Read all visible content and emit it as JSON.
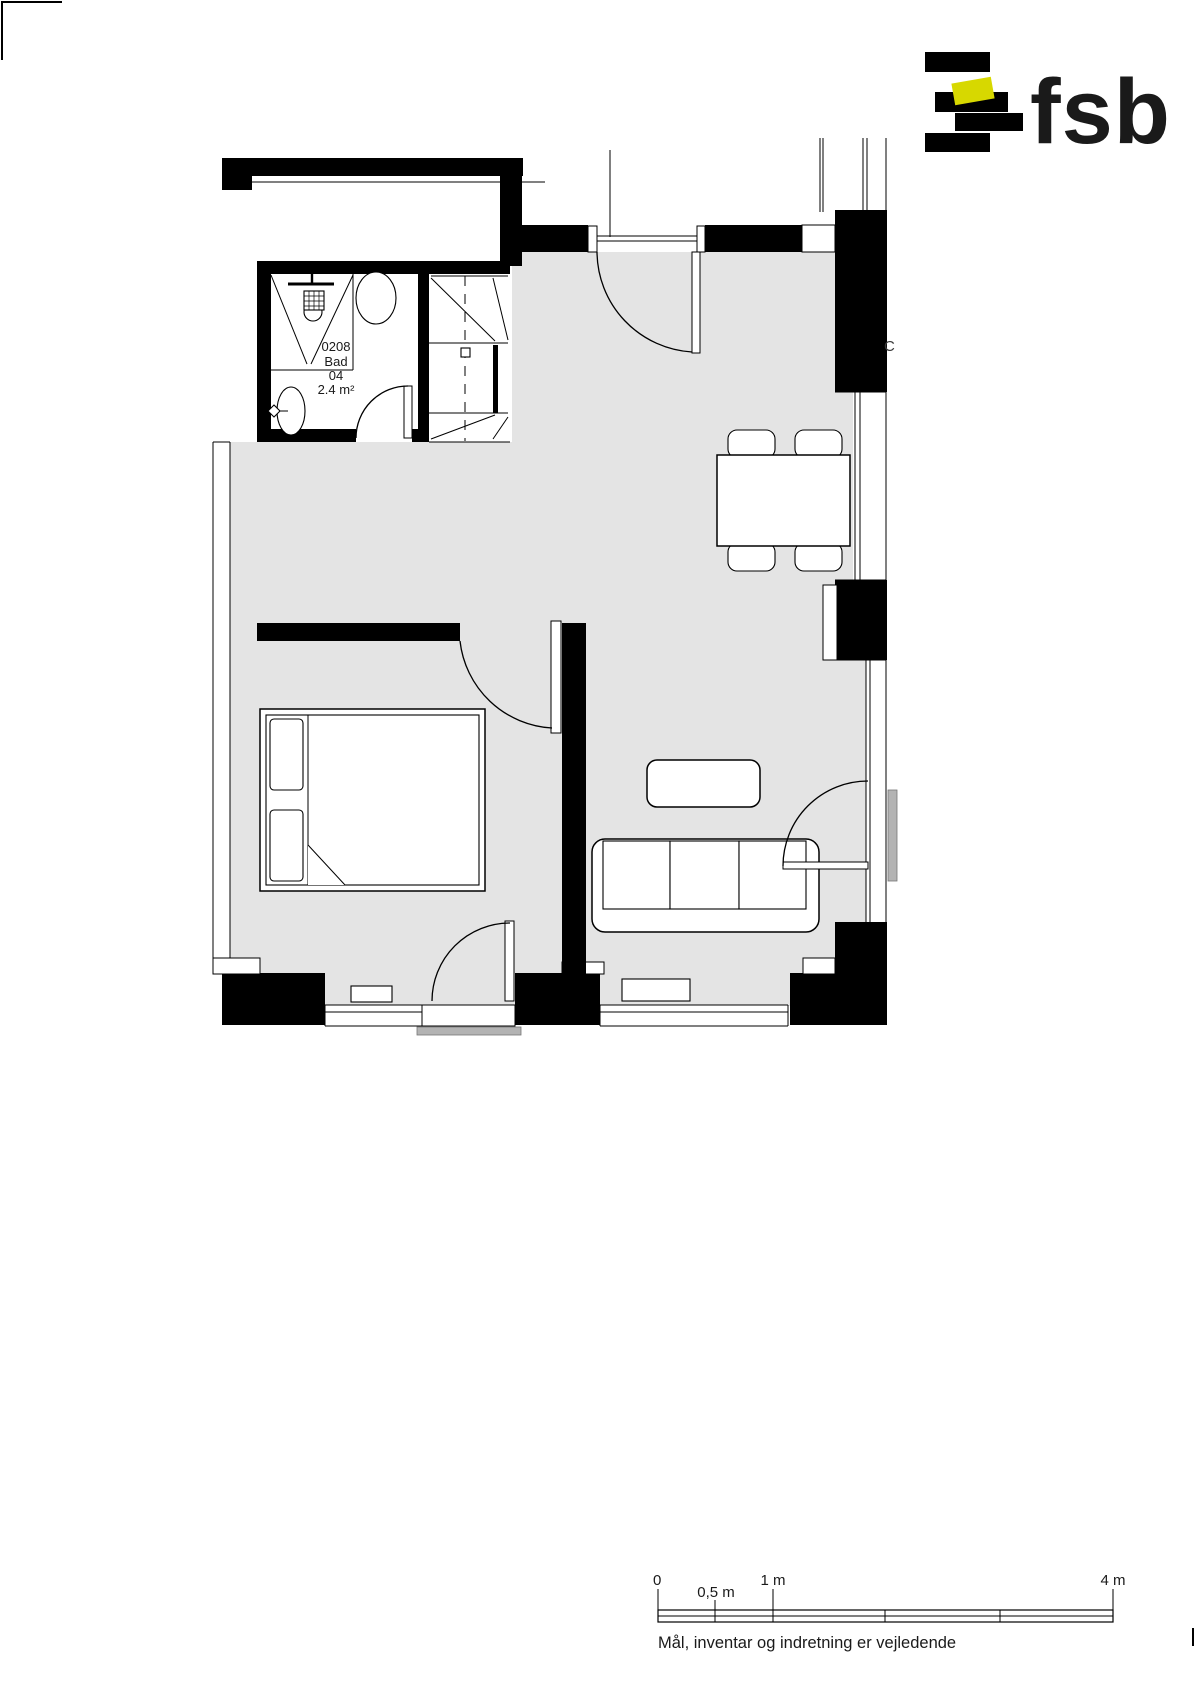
{
  "logo": {
    "text": "fsb",
    "bar_color": "#000000",
    "accent_color": "#d7d800"
  },
  "plan": {
    "room_label": {
      "number": "0208",
      "name": "Bad",
      "unit": "04",
      "area": "2.4 m²"
    },
    "grid_label": "C",
    "colors": {
      "floor": "#e4e4e4",
      "wall": "#000000",
      "balcony_slab": "#b3b3b3"
    }
  },
  "scale_bar": {
    "ticks": [
      {
        "label": "0"
      },
      {
        "label": "0,5 m"
      },
      {
        "label": "1 m"
      },
      {
        "label": "4 m"
      }
    ]
  },
  "footer": {
    "disclaimer": "Mål, inventar og indretning er vejledende"
  }
}
